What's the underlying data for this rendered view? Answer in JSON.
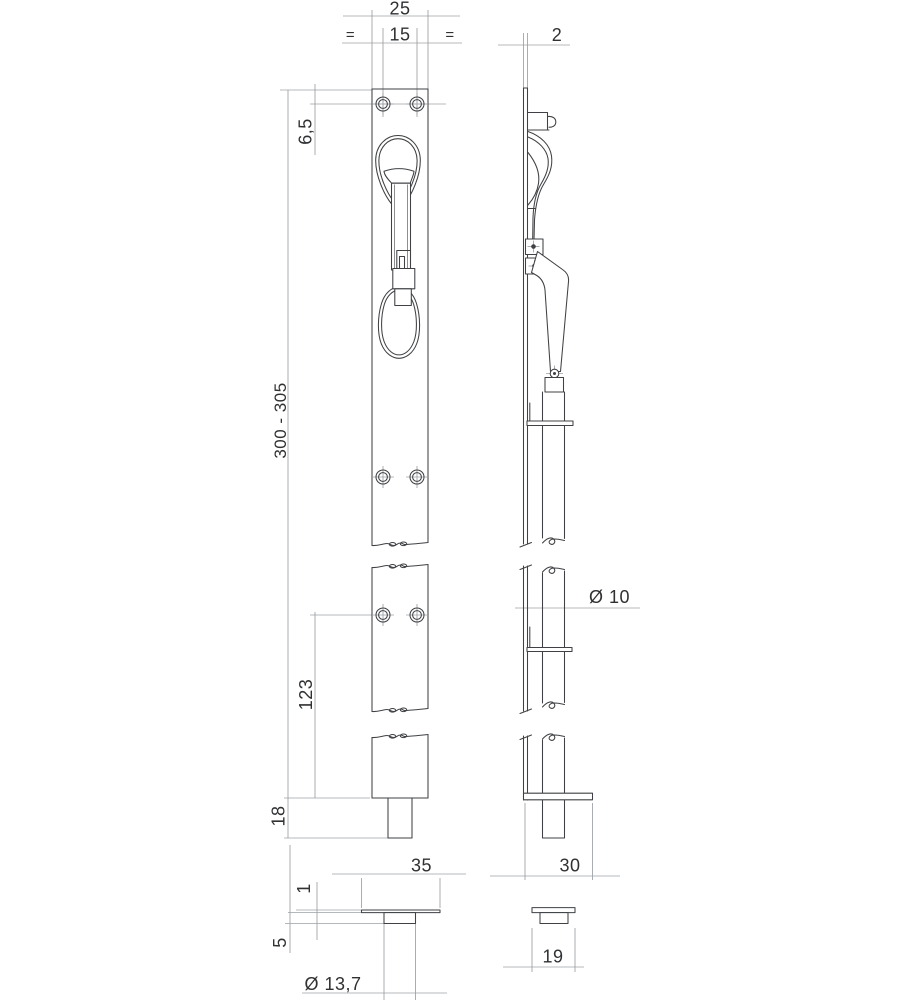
{
  "views": {
    "front": {
      "dims": {
        "plate_width": "25",
        "hole_spacing": "15",
        "equal_left": "=",
        "equal_right": "=",
        "top_edge_offset": "6,5",
        "overall_length": "300 - 305",
        "lower_hole_offset": "123",
        "bolt_throw": "18"
      }
    },
    "side": {
      "dims": {
        "faceplate_thickness": "2",
        "rod_diameter": "Ø 10",
        "keeper_depth": "30"
      }
    },
    "bottom_socket": {
      "dims": {
        "plate_width": "35",
        "plate_thickness": "1",
        "collar_height": "5",
        "hole_diameter": "Ø 13,7"
      }
    },
    "bottom_guide": {
      "dims": {
        "width": "19"
      }
    }
  },
  "colors": {
    "line_dark": "#3f4144",
    "line_light": "#9ba0a4",
    "dimension_text": "#2f3133",
    "background": "#ffffff"
  }
}
